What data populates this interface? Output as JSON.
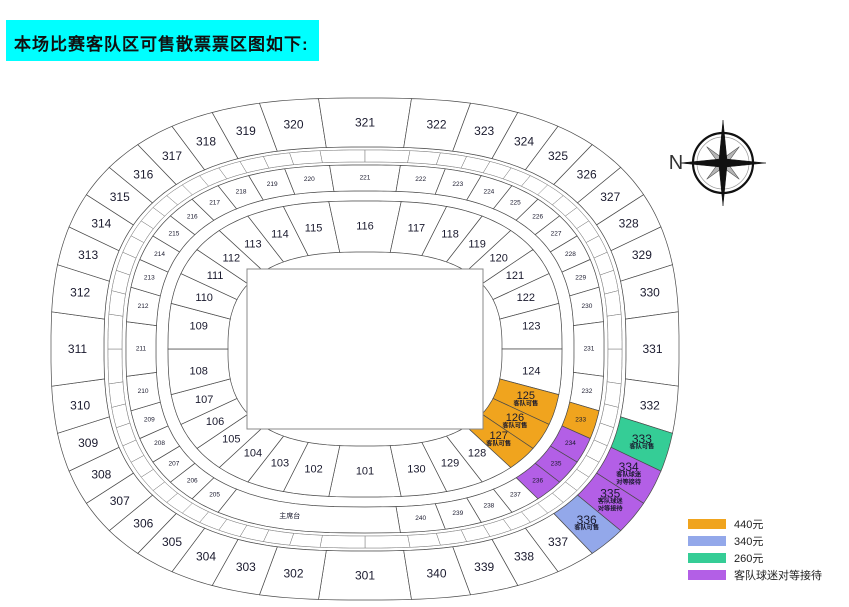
{
  "title": {
    "text": "本场比赛客队区可售散票票区图如下:",
    "bg_color": "#00ffff"
  },
  "compass": {
    "label": "N"
  },
  "legend": {
    "items": [
      {
        "label": "440元",
        "color": "#f0a41e"
      },
      {
        "label": "340元",
        "color": "#93a8ea"
      },
      {
        "label": "260元",
        "color": "#35cd96"
      },
      {
        "label": "客队球迷对等接待",
        "color": "#b35fe6"
      }
    ]
  },
  "stadium": {
    "podium_label": "主席台",
    "rings": {
      "inner": {
        "sections": [
          "101",
          "102",
          "103",
          "104",
          "105",
          "106",
          "107",
          "108",
          "109",
          "110",
          "111",
          "112",
          "113",
          "114",
          "115",
          "116",
          "117",
          "118",
          "119",
          "120",
          "121",
          "122",
          "123",
          "124",
          "125",
          "126",
          "127",
          "128",
          "129",
          "130"
        ]
      },
      "middle": {
        "sections": [
          "201",
          "202",
          "203",
          "204",
          "205",
          "206",
          "207",
          "208",
          "209",
          "210",
          "211",
          "212",
          "213",
          "214",
          "215",
          "216",
          "217",
          "218",
          "219",
          "220",
          "221",
          "222",
          "223",
          "224",
          "225",
          "226",
          "227",
          "228",
          "229",
          "230",
          "231",
          "232",
          "233",
          "234",
          "235",
          "236",
          "237",
          "238",
          "239",
          "240"
        ],
        "podium_replaces": [
          "201",
          "202",
          "203",
          "204"
        ]
      },
      "outer": {
        "sections": [
          "301",
          "302",
          "303",
          "304",
          "305",
          "306",
          "307",
          "308",
          "309",
          "310",
          "311",
          "312",
          "313",
          "314",
          "315",
          "316",
          "317",
          "318",
          "319",
          "320",
          "321",
          "322",
          "323",
          "324",
          "325",
          "326",
          "327",
          "328",
          "329",
          "330",
          "331",
          "332",
          "333",
          "334",
          "335",
          "336",
          "337",
          "338",
          "339",
          "340"
        ]
      }
    },
    "colored_sections": {
      "125": {
        "color": "#f0a41e",
        "lines": [
          "客队可售"
        ]
      },
      "126": {
        "color": "#f0a41e",
        "lines": [
          "客队可售"
        ]
      },
      "127": {
        "color": "#f0a41e",
        "lines": [
          "客队可售"
        ]
      },
      "233": {
        "color": "#f0a41e",
        "lines": []
      },
      "234": {
        "color": "#b35fe6",
        "lines": []
      },
      "235": {
        "color": "#b35fe6",
        "lines": []
      },
      "236": {
        "color": "#b35fe6",
        "lines": []
      },
      "333": {
        "color": "#35cd96",
        "lines": [
          "客队可售"
        ]
      },
      "334": {
        "color": "#b35fe6",
        "lines": [
          "客队球迷",
          "对等接待"
        ]
      },
      "335": {
        "color": "#b35fe6",
        "lines": [
          "客队球迷",
          "对等接待"
        ]
      },
      "336": {
        "color": "#93a8ea",
        "lines": [
          "客队可售"
        ]
      }
    }
  }
}
